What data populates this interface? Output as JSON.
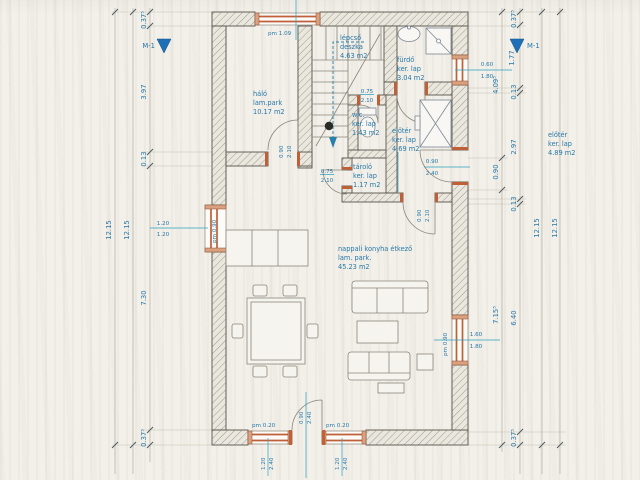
{
  "rooms": {
    "halo": {
      "name": "háló",
      "finish": "lam.park",
      "area": "10.17 m2"
    },
    "lepcso": {
      "name": "lépcső",
      "finish": "deszka",
      "area": "4.63 m2"
    },
    "furdo": {
      "name": "fürdő",
      "finish": "ker. lap",
      "area": "3.04 m2"
    },
    "wc": {
      "name": "w.c.",
      "finish": "ker. lap",
      "area": "1.43 m2"
    },
    "eloter": {
      "name": "előtér",
      "finish": "ker. lap",
      "area": "4.69 m2"
    },
    "tarolo": {
      "name": "tároló",
      "finish": "ker. lap",
      "area": "1.17 m2"
    },
    "nappali": {
      "name": "nappali konyha étkező",
      "finish": "lam. park.",
      "area": "45.23 m2"
    },
    "note": {
      "name": "előtér",
      "finish": "ker. lap",
      "area": "4.89 m2"
    }
  },
  "dims": {
    "total": "12.15",
    "left_chain": [
      "0.37⁵",
      "3.97",
      "0.13",
      "7.30",
      "0.37⁵"
    ],
    "right_inner": [
      "4.09⁵",
      "0.90",
      "7.15⁵"
    ],
    "right_chain": [
      "0.37⁵",
      "1.77",
      "0.13",
      "2.97",
      "0.13",
      "6.40",
      "0.37⁵"
    ]
  },
  "markers": {
    "section": "M-1"
  },
  "openings": {
    "top_window": {
      "pm": "pm 1.09"
    },
    "left_window": {
      "w": "1.20",
      "h": "1.20",
      "pm": "pm 0.90"
    },
    "right_upper_window": {
      "w": "0.60",
      "h": "1.80"
    },
    "right_lower_window": {
      "w": "1.60",
      "h": "1.80",
      "pm": "pm 0.90"
    },
    "entry_door": {
      "w": "0.90",
      "h": "2.40"
    },
    "bottom_door": {
      "w": "0.90",
      "h": "2.40"
    },
    "bottom_window": {
      "w": "1.20",
      "h": "2.40",
      "pm": "pm 0.20"
    },
    "halo_door": {
      "w": "0.90",
      "h": "2.10"
    },
    "wc_door": {
      "w": "0.75",
      "h": "2.10"
    },
    "tarolo_door": {
      "w": "0.75",
      "h": "2.10"
    },
    "eloter_opening": {
      "w": "0.90",
      "h": "2.10"
    }
  }
}
